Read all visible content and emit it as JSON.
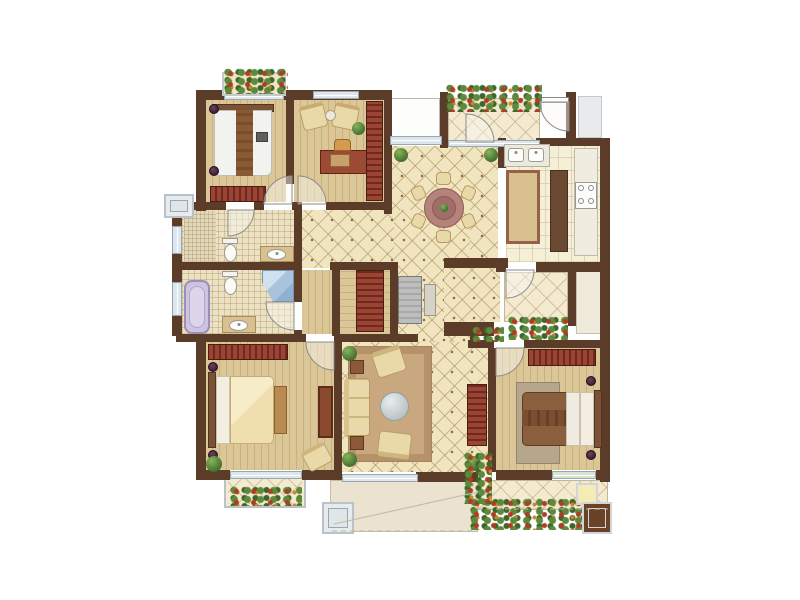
{
  "document": {
    "kind": "residential floor plan rendering",
    "visible_text": "none",
    "background": "#ffffff"
  },
  "palette": {
    "wall": "#5a3c28",
    "wood_floor": "#dac697",
    "mosaic_tile": "#f1e5bf",
    "bath_tile": "#ece1c2",
    "accent_cabinet_red": "#9c4434",
    "window_glass": "#dce6ec",
    "plant_green": "#4e7a36",
    "terrace": "#ebe3d0",
    "bedding_cream": "#f0dfae",
    "bedding_white": "#f2f2ef",
    "sofa_cream": "#ead9a8",
    "rug": "#c9a87f",
    "dining_table": "#b5837c",
    "bathtub_lavender": "#cfc3e2",
    "shower_blue": "#aac3dd"
  },
  "rooms": [
    {
      "id": "bedroom-top-left",
      "floor": "wood",
      "furniture": [
        "double bed with white duvet and brown runner",
        "striped wardrobe",
        "two bedside lamps",
        "flower box window"
      ]
    },
    {
      "id": "study",
      "floor": "wood",
      "furniture": [
        "writing desk",
        "desk chair",
        "two armchairs",
        "round tea table",
        "tall bookcase"
      ]
    },
    {
      "id": "entry-balcony",
      "floor": "mosaic tile",
      "furniture": [
        "planter row",
        "entrance door"
      ]
    },
    {
      "id": "dining-room",
      "floor": "mosaic tile",
      "furniture": [
        "round table",
        "six chairs",
        "two potted plants"
      ]
    },
    {
      "id": "kitchen",
      "floor": "ceramic tile",
      "furniture": [
        "double sink",
        "island counter",
        "four burner stove",
        "tall cabinet"
      ]
    },
    {
      "id": "bathroom",
      "floor": "bath tile",
      "furniture": [
        "toilet",
        "wash basin"
      ]
    },
    {
      "id": "master-bathroom",
      "floor": "bath tile",
      "furniture": [
        "bathtub",
        "corner shower",
        "toilet",
        "wash basin"
      ]
    },
    {
      "id": "hallway",
      "floor": "mosaic tile",
      "furniture": [
        "console table",
        "striped storage cabinet"
      ]
    },
    {
      "id": "living-room",
      "floor": "mosaic tile with rug",
      "furniture": [
        "three seat sofa",
        "two armchairs",
        "round glass coffee table",
        "two side tables",
        "sideboard",
        "corner plants"
      ]
    },
    {
      "id": "master-bedroom",
      "floor": "wood",
      "furniture": [
        "double bed with cream duvet",
        "striped wardrobe",
        "bench",
        "dresser",
        "armchair",
        "potted plant",
        "flower balcony"
      ]
    },
    {
      "id": "bedroom-right",
      "floor": "wood",
      "furniture": [
        "double bed with brown duvet",
        "striped wardrobe",
        "rug",
        "two bedside lamps"
      ]
    },
    {
      "id": "service-balcony",
      "floor": "mosaic tile",
      "furniture": [
        "flower bed"
      ]
    },
    {
      "id": "terrace",
      "floor": "stone",
      "furniture": [
        "column ornament"
      ]
    },
    {
      "id": "rear-balcony",
      "floor": "mosaic tile",
      "furniture": [
        "planting row",
        "doormat",
        "column ornament"
      ]
    }
  ]
}
